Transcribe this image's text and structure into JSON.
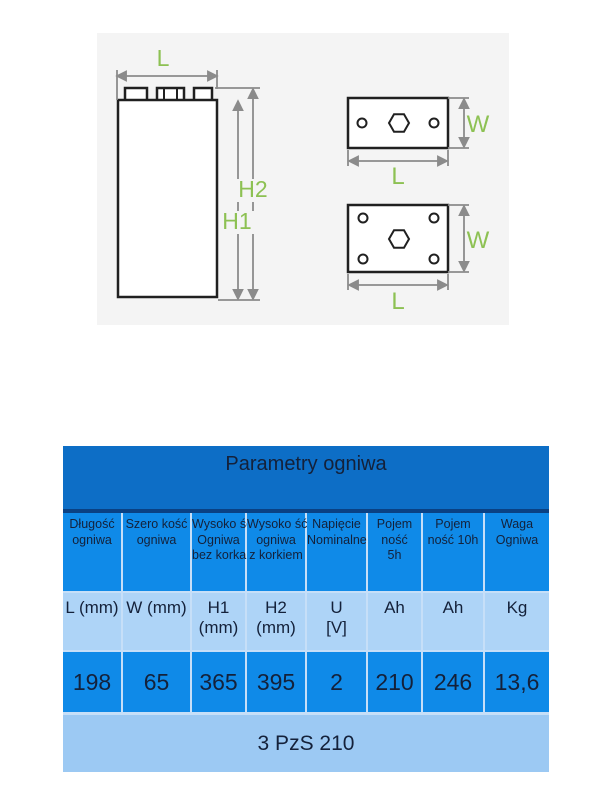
{
  "diagram": {
    "labels": {
      "length": "L",
      "width": "W",
      "height_body": "H1",
      "height_total": "H2"
    },
    "colors": {
      "label_green": "#8dc153",
      "dimension_gray": "#8b8b8b",
      "line_black": "#202020",
      "panel_bg": "#f4f4f4"
    }
  },
  "table": {
    "title": "Parametry ogniwa",
    "columns": [
      {
        "header": "Długość\nogniwa",
        "unit": "L (mm)",
        "value": "198"
      },
      {
        "header": "Szero kość\nogniwa",
        "unit": "W (mm)",
        "value": "65"
      },
      {
        "header": "Wysoko ść\nOgniwa\nbez korka",
        "unit": "H1\n(mm)",
        "value": "365"
      },
      {
        "header": "Wysoko ść\nogniwa\nz korkiem",
        "unit": "H2\n(mm)",
        "value": "395"
      },
      {
        "header": "Napięcie\nNominalne",
        "unit": "U\n[V]",
        "value": "2"
      },
      {
        "header": "Pojem\nność\n5h",
        "unit": "Ah",
        "value": "210"
      },
      {
        "header": "Pojem\nność 10h",
        "unit": "Ah",
        "value": "246"
      },
      {
        "header": "Waga\nOgniwa",
        "unit": "Kg",
        "value": "13,6"
      }
    ],
    "footer": "3 PzS 210",
    "colors": {
      "title_bg": "#0d6ec6",
      "title_rule": "#0a4183",
      "cell_blue": "#0f8ae8",
      "cell_light_blue": "#aed4f7",
      "footer_bg": "#9cc9f3",
      "text": "#14213a"
    }
  }
}
